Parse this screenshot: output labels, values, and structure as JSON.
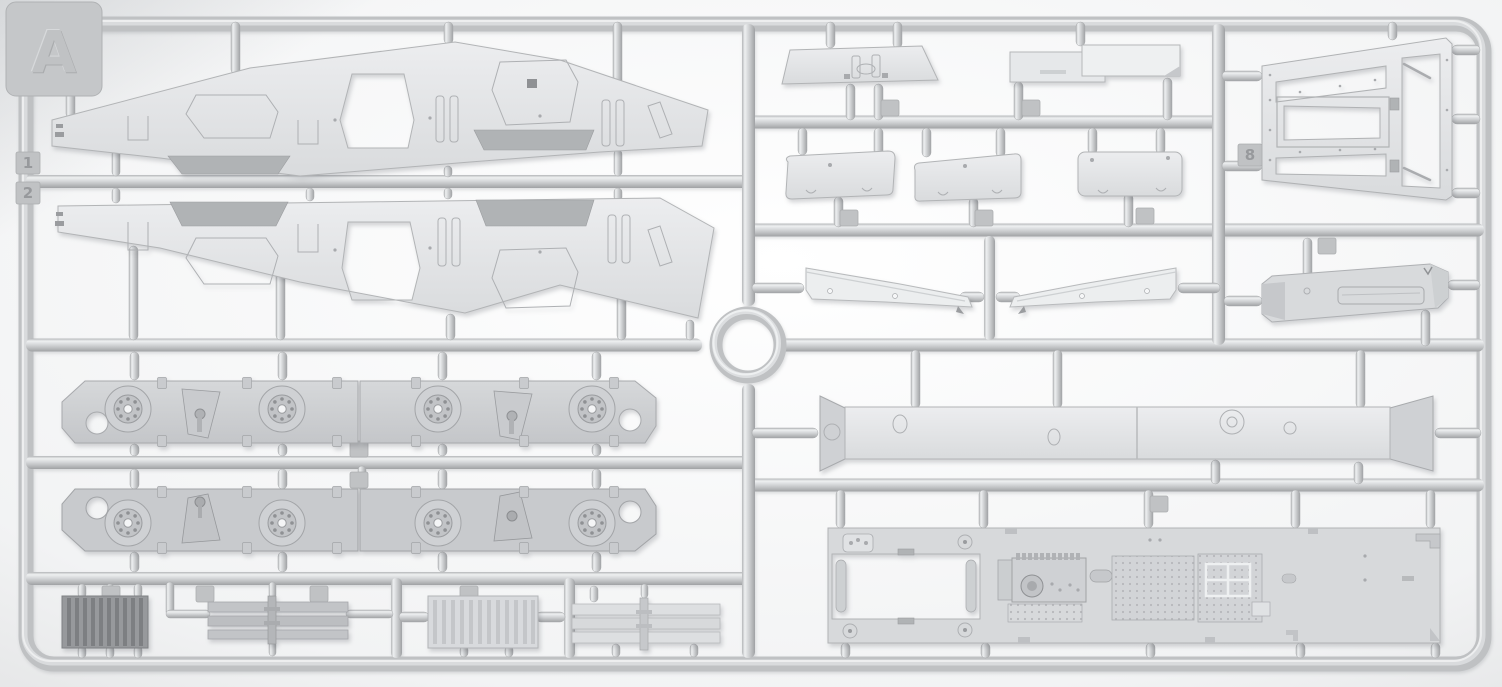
{
  "sprue": {
    "letter": "A",
    "edge_tabs": {
      "upper": "1",
      "lower": "2",
      "inner": "8"
    },
    "colors": {
      "plastic_light": "#e4e6e8",
      "plastic_mid": "#cdcfd2",
      "plastic_dark": "#97999c",
      "runner": "#c6c8ca",
      "background": "#f2f3f4"
    },
    "parts": [
      {
        "name": "hull-side-panel-upper",
        "description": "long hull side panel with trapezoid opening and recessed hatches"
      },
      {
        "name": "hull-side-panel-lower",
        "description": "mirrored hull side panel with trapezoid opening"
      },
      {
        "name": "wheel-panel-row1-left",
        "description": "lower hull side plate with two wheel hubs and bracket"
      },
      {
        "name": "wheel-panel-row1-right",
        "description": "lower hull side plate with two wheel hubs and bracket"
      },
      {
        "name": "wheel-panel-row2-left",
        "description": "mirrored lower hull side plate with hubs"
      },
      {
        "name": "wheel-panel-row2-right",
        "description": "mirrored lower hull side plate with hubs"
      },
      {
        "name": "radiator-dark",
        "description": "dark ribbed radiator block"
      },
      {
        "name": "radiator-slatted",
        "description": "slatted radiator core with center runner"
      },
      {
        "name": "radiator-ribbed-light",
        "description": "light ribbed radiator core"
      },
      {
        "name": "panel-slatted-light",
        "description": "light slatted panel with center runner"
      },
      {
        "name": "trapezoid-plate",
        "description": "small trapezoid roof plate with clamps"
      },
      {
        "name": "overlapping-plates",
        "description": "two flat overlapping rectangular plates"
      },
      {
        "name": "mudguard-panel-1",
        "description": "rounded fender panel"
      },
      {
        "name": "mudguard-panel-2",
        "description": "rounded fender panel"
      },
      {
        "name": "mudguard-panel-3",
        "description": "rounded fender panel"
      },
      {
        "name": "blade-left",
        "description": "long tapered blade strip with holes"
      },
      {
        "name": "blade-right",
        "description": "long tapered blade strip with holes"
      },
      {
        "name": "cross-beam",
        "description": "long beam with flared trapezoid ends and bosses"
      },
      {
        "name": "engine-deck-frame",
        "description": "trapezoid frame with inner opening and hinged door"
      },
      {
        "name": "exhaust-box",
        "description": "rectangular muffler box with recessed louver"
      },
      {
        "name": "hull-floor-plate",
        "description": "large floor plate with cutout, gearbox detail and tread texture"
      }
    ]
  }
}
